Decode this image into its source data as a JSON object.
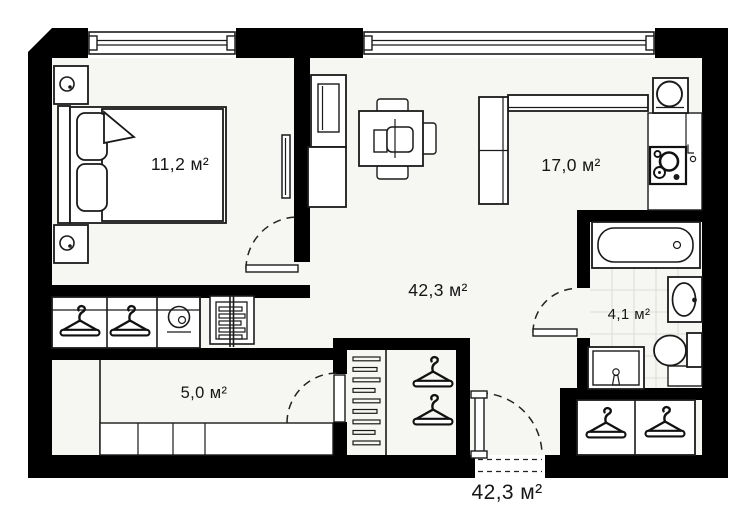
{
  "plan": {
    "type": "apartment-floor-plan",
    "rooms": [
      {
        "name": "bedroom",
        "area": "11,2 м²"
      },
      {
        "name": "living-kitchen",
        "area": "17,0 м²"
      },
      {
        "name": "hall",
        "area": "42,3 м²"
      },
      {
        "name": "bathroom",
        "area": "4,1 м²"
      },
      {
        "name": "entry-hall",
        "area": "5,0 м²"
      }
    ],
    "total_area": "42,3 м²"
  },
  "colors": {
    "wall": "#000000",
    "floor": "#f6f6f3",
    "line": "#1a1a1a",
    "tile": "#dcdcd8",
    "background": "#ffffff"
  }
}
